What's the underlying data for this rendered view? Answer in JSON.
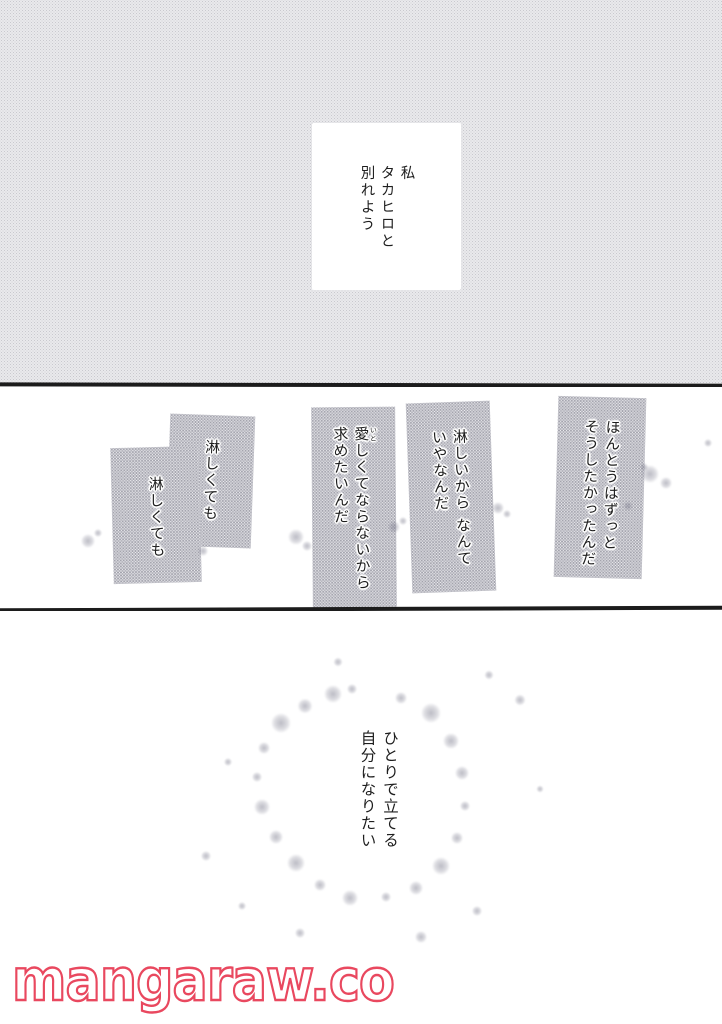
{
  "page": {
    "watermark": {
      "text": "mangaraw.co",
      "color": "#e9485f"
    },
    "ink_color": "#1c1c1c"
  },
  "panels": {
    "top": {
      "speech_bubble": {
        "lines": [
          "私",
          "タカヒロと",
          "別れよう"
        ]
      }
    },
    "middle": {
      "caption_honest": {
        "lines": [
          "ほんとうはずっと",
          "そうしたかったんだ"
        ]
      },
      "caption_lonely_reason": {
        "lines": [
          "淋しいから なんて",
          "いやなんだ"
        ]
      },
      "caption_love": {
        "ruby_base": "愛",
        "ruby_text": "いと",
        "line1_rest": "しくてならないから",
        "line2": "求めたいんだ"
      },
      "caption_even_if_lonely_1": {
        "lines": [
          "淋しくても"
        ]
      },
      "caption_even_if_lonely_2": {
        "lines": [
          "淋しくても"
        ]
      }
    },
    "bottom": {
      "monologue": {
        "lines": [
          "ひとりで立てる",
          "自分になりたい"
        ]
      }
    }
  }
}
